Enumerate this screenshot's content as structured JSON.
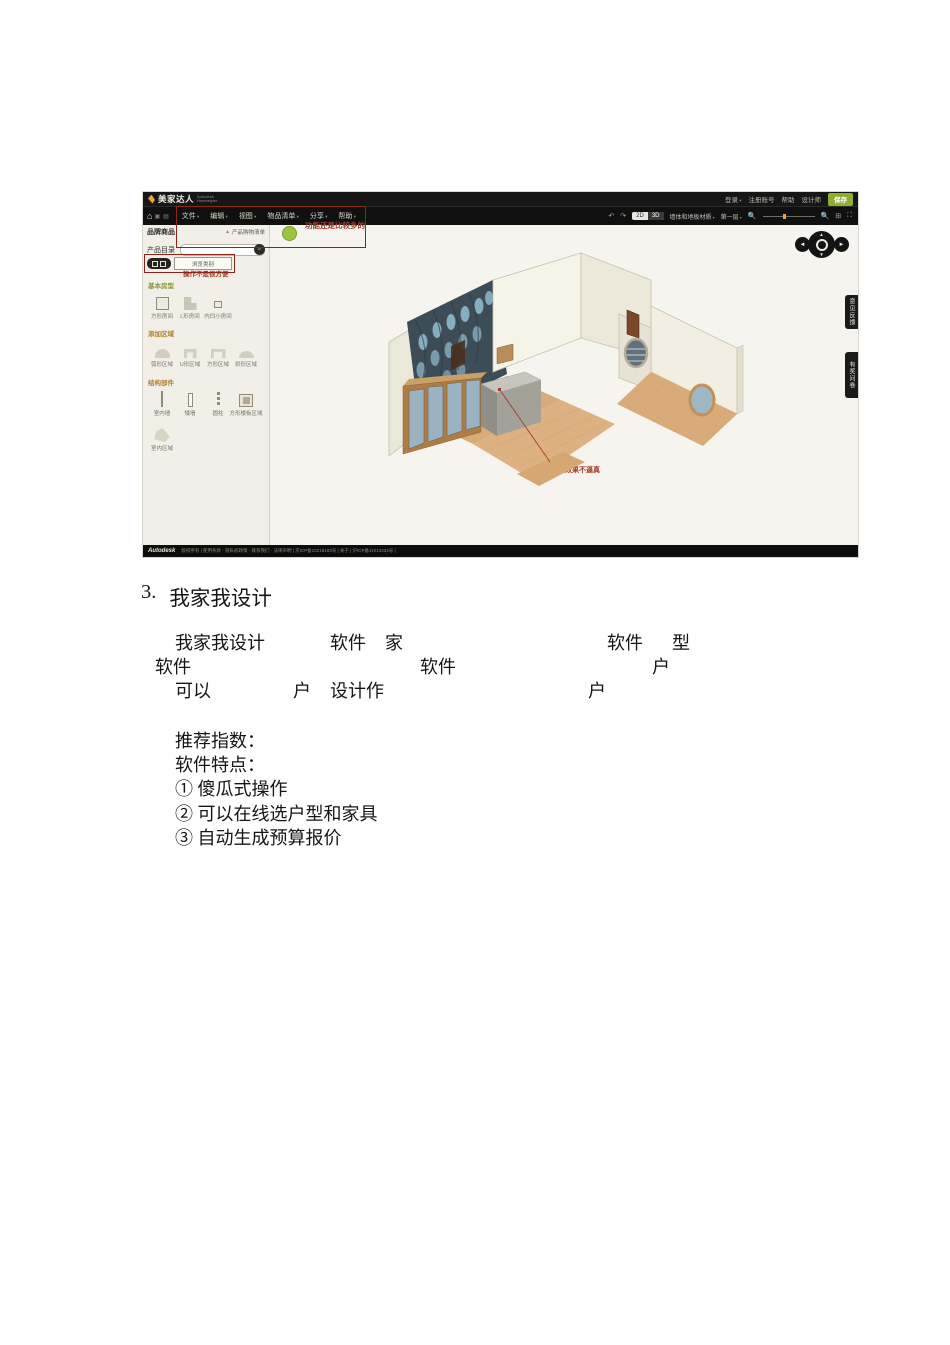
{
  "colors": {
    "annotation_red": "#a0392a",
    "save_green": "#8fae2f",
    "section_olive": "#8a9738",
    "section_orange": "#b0802e",
    "wallpaper_navy": "#3d4d58"
  },
  "app": {
    "logo": {
      "name": "美家达人",
      "sub": "Autodesk\nHomestyler"
    },
    "account": {
      "login": "登录",
      "register": "注册账号",
      "help": "帮助",
      "designer": "设计师",
      "save": "保存"
    },
    "menus": [
      "文件",
      "编辑",
      "视图",
      "物品清单",
      "分享",
      "帮助"
    ],
    "viewbar": {
      "toggle_2d": "2D",
      "toggle_3d": "3D",
      "materials": "墙体和地板材质",
      "floor": "第一层"
    },
    "panel": {
      "brand": "品牌商品",
      "shoplist": "产品购物清单",
      "catalog": "产品目录",
      "browse": "浏览类别",
      "sections": [
        {
          "title": "基本房型",
          "items": [
            "方形房间",
            "L形房间",
            "内凹小房间"
          ]
        },
        {
          "title": "添加区域",
          "items": [
            "弧形区域",
            "U形区域",
            "方形区域",
            "拱形区域"
          ]
        },
        {
          "title": "结构部件",
          "items": [
            "室内墙",
            "矮墙",
            "圆柱",
            "方形楼板区域",
            "室内区域"
          ]
        }
      ]
    },
    "annotations": {
      "features": "功能还是比较多的",
      "operation": "操作不是很方便",
      "model": "模型效果不逼真"
    },
    "side_tabs": [
      "意见反馈",
      "有奖问卷"
    ],
    "footer": {
      "brand": "Autodesk",
      "info": "版权所有 | 使用条款 · 隐私权政策 · 联系我们 · 法律声明 | 京ICP备10218183号 | 关于 | 沪ICP备11013434号 |"
    }
  },
  "doc": {
    "heading": {
      "num": "3.",
      "title": "我家我设计"
    },
    "para": {
      "l1": [
        "我家我设计",
        "软件",
        "家",
        "软件",
        "型"
      ],
      "l2": [
        "软件",
        "软件",
        "户"
      ],
      "l3": [
        "可以",
        "户",
        "设计作",
        "户"
      ]
    },
    "list": [
      "推荐指数：",
      "软件特点：",
      "① 傻瓜式操作",
      "② 可以在线选户型和家具",
      "③ 自动生成预算报价"
    ]
  }
}
